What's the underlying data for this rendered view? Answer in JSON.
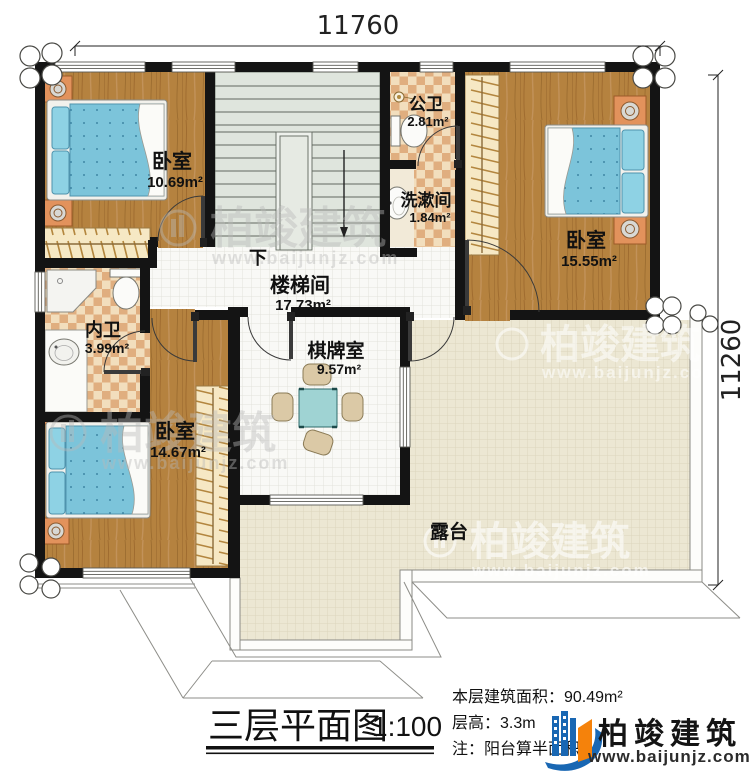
{
  "dimensions": {
    "top": "11760",
    "right": "11260"
  },
  "rooms": [
    {
      "name": "卧室",
      "area": "10.69m²"
    },
    {
      "name": "公卫",
      "area": "2.81m²"
    },
    {
      "name": "洗漱间",
      "area": "1.84m²"
    },
    {
      "name": "卧室",
      "area": "15.55m²"
    },
    {
      "name": "楼梯间",
      "area": "17.73m²"
    },
    {
      "name": "内卫",
      "area": "3.99m²"
    },
    {
      "name": "卧室",
      "area": "14.67m²"
    },
    {
      "name": "棋牌室",
      "area": "9.57m²"
    },
    {
      "name": "露台",
      "area": ""
    }
  ],
  "stairs": {
    "direction_label": "下"
  },
  "titleblock": {
    "title": "三层平面图",
    "scale": "1:100",
    "floor_area": "本层建筑面积：90.49m²",
    "floor_height": "层高：3.3m",
    "note": "注：阳台算半面积"
  },
  "brand": {
    "name": "柏竣建筑",
    "website": "www.baijunjz.com"
  },
  "watermark": {
    "text": "柏竣建筑",
    "website": "www.baijunjz.com"
  },
  "colors": {
    "wall": "#141414",
    "wood": "#b5823f",
    "bath_tile": "#e9c595",
    "hall_tile": "#f7f7f4",
    "terrace": "#ece7d3",
    "stair": "#dfe5dd",
    "bed": "#7cc4da",
    "logo_blue": "#1967b3",
    "logo_orange": "#f5820b"
  }
}
